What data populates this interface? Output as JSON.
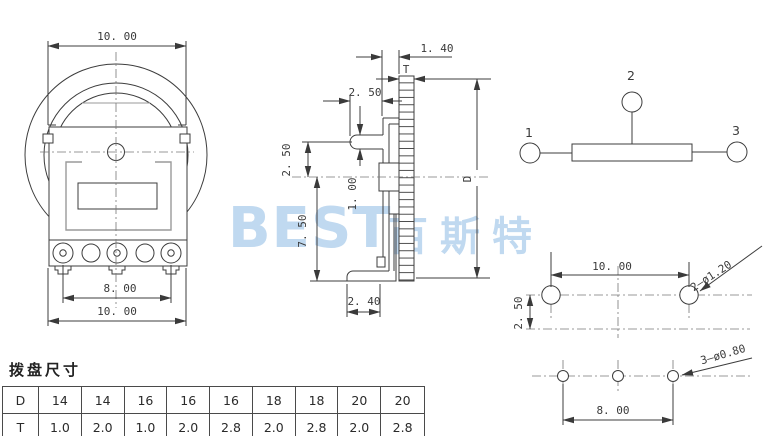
{
  "watermark": {
    "latin": "BEST",
    "cjk": "百斯特"
  },
  "front_view": {
    "dim_dial_width": "10. 00",
    "dim_terminal_span": "8. 00",
    "dim_body_width": "10. 00"
  },
  "side_view": {
    "dim_face_to_rim": "1. 40",
    "rim_thickness_label": "T",
    "dim_pin_length": "2. 50",
    "dim_pin_axis_offset": "2. 50",
    "dim_pin_diameter": "1. 00",
    "dim_axis_to_foot": "7. 50",
    "dim_foot_length": "2. 40",
    "rim_diameter_label": "D"
  },
  "schematic": {
    "terminal_1": "1",
    "terminal_2": "2",
    "terminal_3": "3"
  },
  "footprint": {
    "dim_mount_hole_span": "10. 00",
    "dim_row_offset": "2. 50",
    "mount_hole_note": "2—ø1.20",
    "terminal_hole_note": "3—ø0.80",
    "dim_terminal_hole_span": "8. 00"
  },
  "size_table": {
    "title": "拨盘尺寸",
    "d_label": "D",
    "t_label": "T",
    "d_values": [
      "14",
      "14",
      "16",
      "16",
      "16",
      "18",
      "18",
      "20",
      "20"
    ],
    "t_values": [
      "1.0",
      "2.0",
      "1.0",
      "2.0",
      "2.8",
      "2.0",
      "2.8",
      "2.0",
      "2.8"
    ]
  },
  "colors": {
    "line": "#3c3c3c",
    "gray_line": "#9a9a9a",
    "centerline": "#777777",
    "watermark": "#c0d9f0",
    "text": "#333333"
  }
}
